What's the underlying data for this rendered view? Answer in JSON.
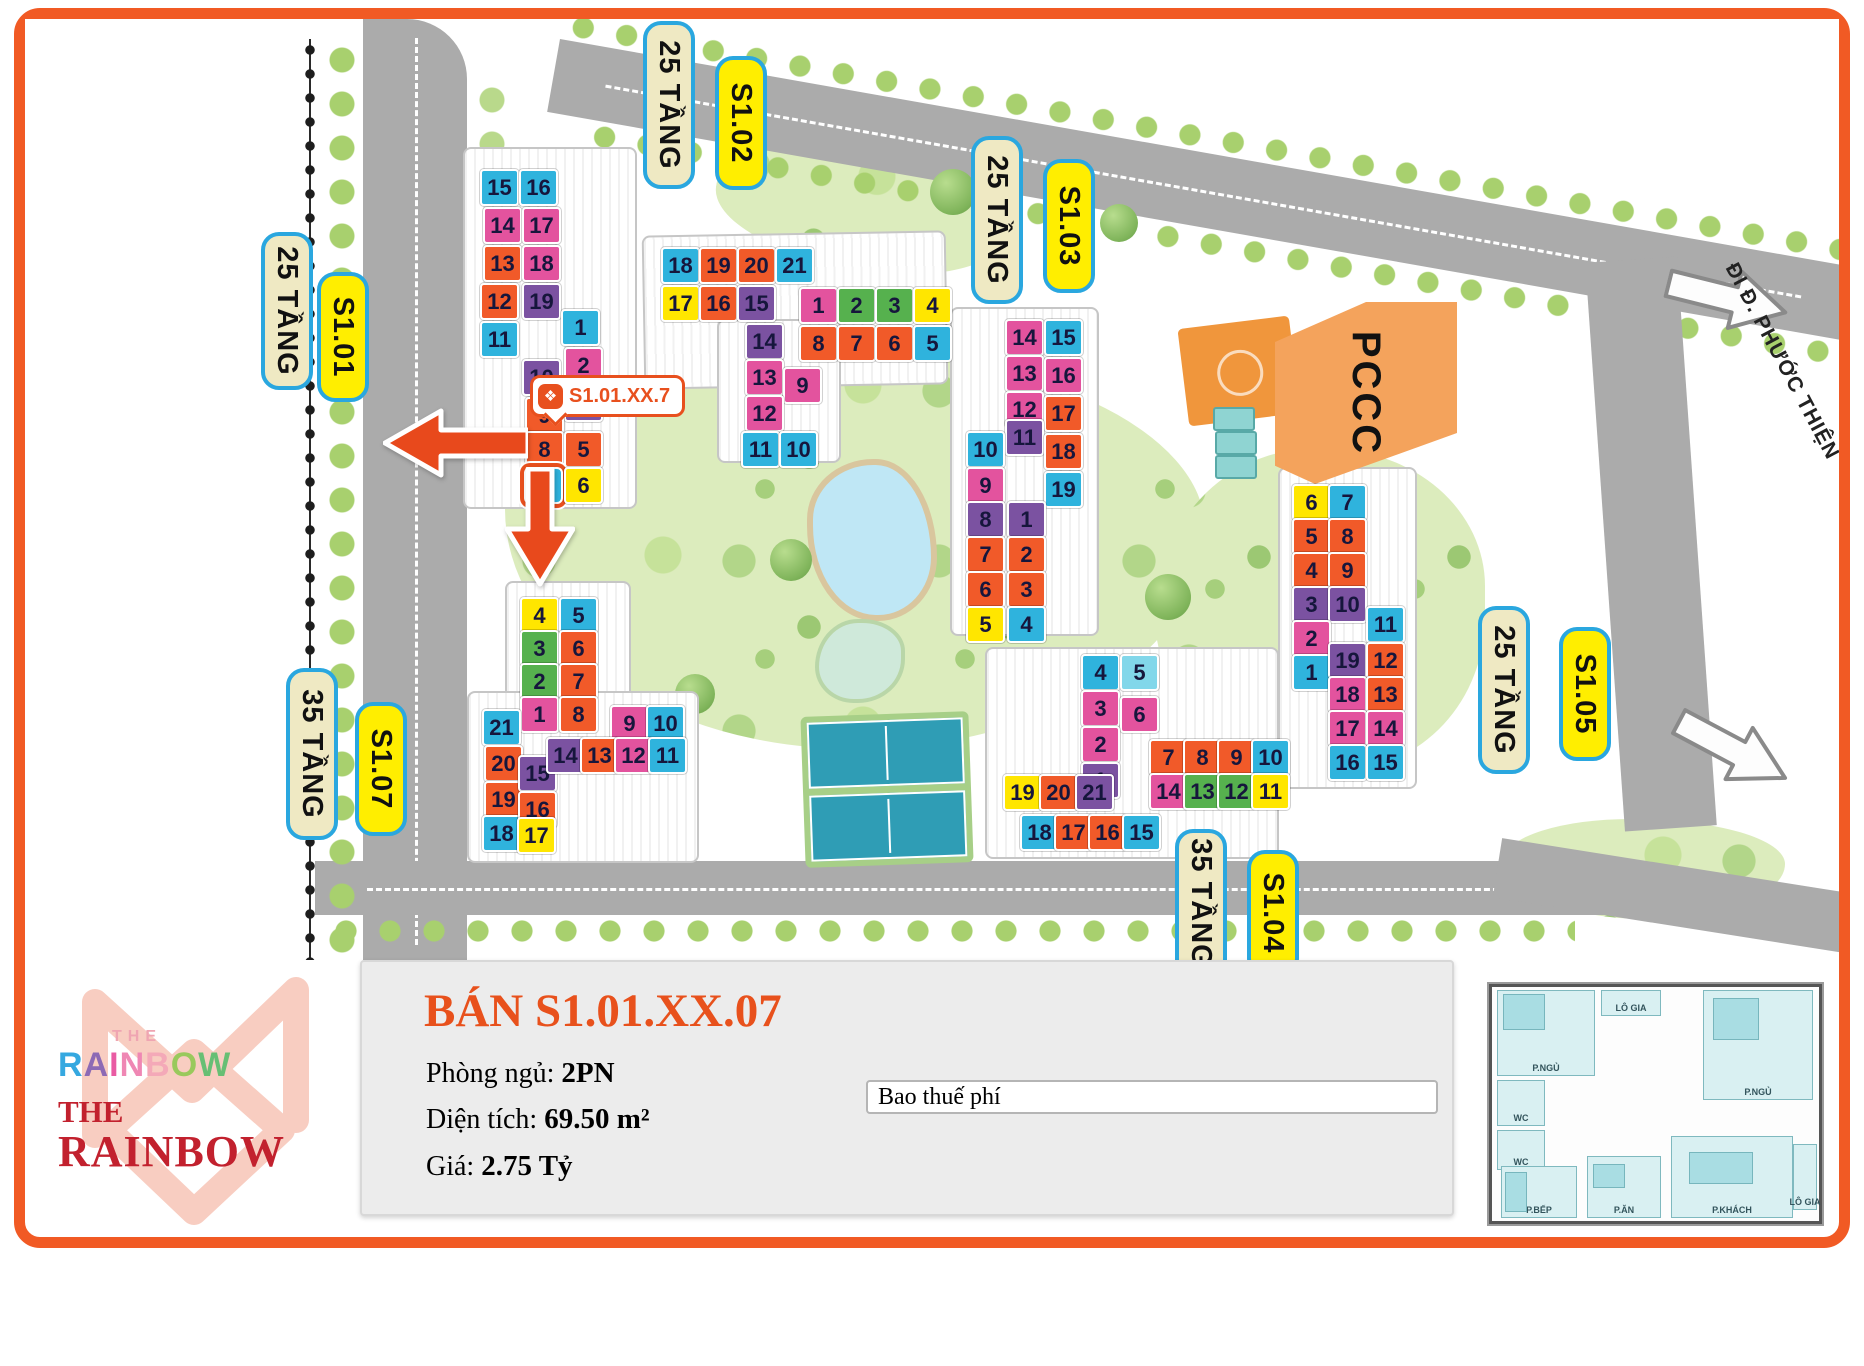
{
  "palette": {
    "cyan": "#2fb3dd",
    "pink": "#e3539e",
    "orange": "#f15a29",
    "purple": "#7b52a1",
    "yellow": "#ffe600",
    "green": "#56b14e",
    "light_cyan": "#82d7ea",
    "highlight": "#e8501e",
    "label_cream": "#efe9c3",
    "label_yellow": "#ffee00",
    "label_border": "#2aa7df",
    "accent": "#e8511c",
    "brand_red": "#c2212e"
  },
  "map": {
    "pccc_label": "PCCC",
    "road_name": "ĐI Đ. PHƯỚC THIỆN",
    "marker": {
      "icon": "rainbow-logo-icon",
      "text": "S1.01.XX.7"
    },
    "labels": [
      {
        "text": "25 TẦNG",
        "style": "cream"
      },
      {
        "text": "S1.01",
        "style": "yellow"
      },
      {
        "text": "25 TẦNG",
        "style": "cream"
      },
      {
        "text": "S1.02",
        "style": "yellow"
      },
      {
        "text": "25 TẦNG",
        "style": "cream"
      },
      {
        "text": "S1.03",
        "style": "yellow"
      },
      {
        "text": "35 TẦNG",
        "style": "cream"
      },
      {
        "text": "S1.07",
        "style": "yellow"
      },
      {
        "text": "25 TẦNG",
        "style": "cream"
      },
      {
        "text": "S1.05",
        "style": "yellow"
      },
      {
        "text": "35 TẦNG",
        "style": "cream"
      },
      {
        "text": "S1.04",
        "style": "yellow"
      }
    ],
    "buildings": [
      {
        "id": "s101",
        "name": "S1.01",
        "tiles": [
          {
            "n": "15",
            "c": "cy",
            "x": 0,
            "y": 0
          },
          {
            "n": "16",
            "c": "cy",
            "x": 39,
            "y": 0
          },
          {
            "n": "14",
            "c": "pk",
            "x": 3,
            "y": 38
          },
          {
            "n": "17",
            "c": "pk",
            "x": 42,
            "y": 38
          },
          {
            "n": "13",
            "c": "or",
            "x": 3,
            "y": 76
          },
          {
            "n": "18",
            "c": "pk",
            "x": 42,
            "y": 76
          },
          {
            "n": "12",
            "c": "or",
            "x": 0,
            "y": 114
          },
          {
            "n": "19",
            "c": "pu",
            "x": 42,
            "y": 114
          },
          {
            "n": "11",
            "c": "cy",
            "x": 0,
            "y": 152
          },
          {
            "n": "1",
            "c": "cy",
            "x": 81,
            "y": 140
          },
          {
            "n": "2",
            "c": "pk",
            "x": 84,
            "y": 178
          },
          {
            "n": "10",
            "c": "pu",
            "x": 42,
            "y": 190
          },
          {
            "n": "3",
            "c": "pu",
            "x": 84,
            "y": 216
          },
          {
            "n": "9",
            "c": "or",
            "x": 45,
            "y": 228
          },
          {
            "n": "8",
            "c": "or",
            "x": 45,
            "y": 262
          },
          {
            "n": "5",
            "c": "or",
            "x": 84,
            "y": 262
          },
          {
            "n": "7",
            "c": "cy",
            "x": 44,
            "y": 298,
            "hl": true
          },
          {
            "n": "6",
            "c": "ye",
            "x": 84,
            "y": 298
          }
        ]
      },
      {
        "id": "s102",
        "name": "S1.02",
        "tiles": [
          {
            "n": "18",
            "c": "cy",
            "x": 0,
            "y": 0
          },
          {
            "n": "19",
            "c": "or",
            "x": 38,
            "y": 0
          },
          {
            "n": "20",
            "c": "or",
            "x": 76,
            "y": 0
          },
          {
            "n": "21",
            "c": "cy",
            "x": 114,
            "y": 0
          },
          {
            "n": "17",
            "c": "ye",
            "x": 0,
            "y": 38
          },
          {
            "n": "16",
            "c": "or",
            "x": 38,
            "y": 38
          },
          {
            "n": "15",
            "c": "pu",
            "x": 76,
            "y": 38
          },
          {
            "n": "14",
            "c": "pu",
            "x": 84,
            "y": 76
          },
          {
            "n": "13",
            "c": "pk",
            "x": 84,
            "y": 112
          },
          {
            "n": "9",
            "c": "pk",
            "x": 122,
            "y": 120
          },
          {
            "n": "12",
            "c": "pk",
            "x": 84,
            "y": 148
          },
          {
            "n": "11",
            "c": "cy",
            "x": 80,
            "y": 184
          },
          {
            "n": "10",
            "c": "cy",
            "x": 118,
            "y": 184
          },
          {
            "n": "1",
            "c": "pk",
            "x": 138,
            "y": 40
          },
          {
            "n": "2",
            "c": "gr",
            "x": 176,
            "y": 40
          },
          {
            "n": "3",
            "c": "gr",
            "x": 214,
            "y": 40
          },
          {
            "n": "4",
            "c": "ye",
            "x": 252,
            "y": 40
          },
          {
            "n": "8",
            "c": "or",
            "x": 138,
            "y": 78
          },
          {
            "n": "7",
            "c": "or",
            "x": 176,
            "y": 78
          },
          {
            "n": "6",
            "c": "or",
            "x": 214,
            "y": 78
          },
          {
            "n": "5",
            "c": "cy",
            "x": 252,
            "y": 78
          }
        ]
      },
      {
        "id": "s103",
        "name": "S1.03",
        "tiles": [
          {
            "n": "14",
            "c": "pk",
            "x": 39,
            "y": 0
          },
          {
            "n": "15",
            "c": "cy",
            "x": 78,
            "y": 0
          },
          {
            "n": "13",
            "c": "pk",
            "x": 39,
            "y": 36
          },
          {
            "n": "16",
            "c": "pk",
            "x": 78,
            "y": 38
          },
          {
            "n": "12",
            "c": "pk",
            "x": 39,
            "y": 72
          },
          {
            "n": "17",
            "c": "or",
            "x": 78,
            "y": 76
          },
          {
            "n": "11",
            "c": "pu",
            "x": 39,
            "y": 100
          },
          {
            "n": "18",
            "c": "or",
            "x": 78,
            "y": 114
          },
          {
            "n": "19",
            "c": "cy",
            "x": 78,
            "y": 152
          },
          {
            "n": "10",
            "c": "cy",
            "x": 0,
            "y": 112
          },
          {
            "n": "9",
            "c": "pk",
            "x": 0,
            "y": 148
          },
          {
            "n": "8",
            "c": "pu",
            "x": 0,
            "y": 182
          },
          {
            "n": "1",
            "c": "pu",
            "x": 41,
            "y": 182
          },
          {
            "n": "7",
            "c": "or",
            "x": 0,
            "y": 217
          },
          {
            "n": "2",
            "c": "or",
            "x": 41,
            "y": 217
          },
          {
            "n": "6",
            "c": "or",
            "x": 0,
            "y": 252
          },
          {
            "n": "3",
            "c": "or",
            "x": 41,
            "y": 252
          },
          {
            "n": "5",
            "c": "ye",
            "x": 0,
            "y": 287
          },
          {
            "n": "4",
            "c": "cy",
            "x": 41,
            "y": 287
          }
        ]
      },
      {
        "id": "s104",
        "name": "S1.04",
        "tiles": [
          {
            "n": "4",
            "c": "cy",
            "x": 8,
            "y": 0
          },
          {
            "n": "5",
            "c": "lc",
            "x": 47,
            "y": 0
          },
          {
            "n": "3",
            "c": "pk",
            "x": 8,
            "y": 36
          },
          {
            "n": "6",
            "c": "pk",
            "x": 47,
            "y": 42
          },
          {
            "n": "2",
            "c": "pk",
            "x": 8,
            "y": 72
          },
          {
            "n": "1",
            "c": "pu",
            "x": 8,
            "y": 108
          },
          {
            "n": "19",
            "c": "ye",
            "x": -70,
            "y": 120
          },
          {
            "n": "20",
            "c": "or",
            "x": -34,
            "y": 120
          },
          {
            "n": "21",
            "c": "pu",
            "x": 2,
            "y": 120
          },
          {
            "n": "7",
            "c": "or",
            "x": 76,
            "y": 85
          },
          {
            "n": "8",
            "c": "or",
            "x": 110,
            "y": 85
          },
          {
            "n": "9",
            "c": "or",
            "x": 144,
            "y": 85
          },
          {
            "n": "10",
            "c": "cy",
            "x": 178,
            "y": 85
          },
          {
            "n": "14",
            "c": "pk",
            "x": 76,
            "y": 119
          },
          {
            "n": "13",
            "c": "gr",
            "x": 110,
            "y": 119
          },
          {
            "n": "12",
            "c": "gr",
            "x": 144,
            "y": 119
          },
          {
            "n": "11",
            "c": "ye",
            "x": 178,
            "y": 119
          },
          {
            "n": "18",
            "c": "cy",
            "x": -53,
            "y": 160
          },
          {
            "n": "17",
            "c": "or",
            "x": -19,
            "y": 160
          },
          {
            "n": "16",
            "c": "or",
            "x": 15,
            "y": 160
          },
          {
            "n": "15",
            "c": "cy",
            "x": 49,
            "y": 160
          }
        ]
      },
      {
        "id": "s105",
        "name": "S1.05",
        "tiles": [
          {
            "n": "6",
            "c": "ye",
            "x": 0,
            "y": 0
          },
          {
            "n": "7",
            "c": "cy",
            "x": 36,
            "y": 0
          },
          {
            "n": "5",
            "c": "or",
            "x": 0,
            "y": 34
          },
          {
            "n": "8",
            "c": "or",
            "x": 36,
            "y": 34
          },
          {
            "n": "4",
            "c": "or",
            "x": 0,
            "y": 68
          },
          {
            "n": "9",
            "c": "or",
            "x": 36,
            "y": 68
          },
          {
            "n": "3",
            "c": "pu",
            "x": 0,
            "y": 102
          },
          {
            "n": "10",
            "c": "pu",
            "x": 36,
            "y": 102
          },
          {
            "n": "2",
            "c": "pk",
            "x": 0,
            "y": 136
          },
          {
            "n": "1",
            "c": "cy",
            "x": 0,
            "y": 170
          },
          {
            "n": "11",
            "c": "cy",
            "x": 74,
            "y": 122
          },
          {
            "n": "19",
            "c": "pu",
            "x": 36,
            "y": 158
          },
          {
            "n": "12",
            "c": "or",
            "x": 74,
            "y": 158
          },
          {
            "n": "18",
            "c": "pk",
            "x": 36,
            "y": 192
          },
          {
            "n": "13",
            "c": "or",
            "x": 74,
            "y": 192
          },
          {
            "n": "17",
            "c": "pk",
            "x": 36,
            "y": 226
          },
          {
            "n": "14",
            "c": "pk",
            "x": 74,
            "y": 226
          },
          {
            "n": "16",
            "c": "cy",
            "x": 36,
            "y": 260
          },
          {
            "n": "15",
            "c": "cy",
            "x": 74,
            "y": 260
          }
        ]
      },
      {
        "id": "s107",
        "name": "S1.07",
        "tiles": [
          {
            "n": "4",
            "c": "ye",
            "x": 40,
            "y": 0
          },
          {
            "n": "5",
            "c": "cy",
            "x": 79,
            "y": 0
          },
          {
            "n": "3",
            "c": "gr",
            "x": 40,
            "y": 33
          },
          {
            "n": "6",
            "c": "or",
            "x": 79,
            "y": 33
          },
          {
            "n": "2",
            "c": "gr",
            "x": 40,
            "y": 66
          },
          {
            "n": "7",
            "c": "or",
            "x": 79,
            "y": 66
          },
          {
            "n": "1",
            "c": "pk",
            "x": 40,
            "y": 99
          },
          {
            "n": "8",
            "c": "or",
            "x": 79,
            "y": 99
          },
          {
            "n": "21",
            "c": "cy",
            "x": 2,
            "y": 112
          },
          {
            "n": "20",
            "c": "or",
            "x": 4,
            "y": 148
          },
          {
            "n": "19",
            "c": "or",
            "x": 4,
            "y": 184
          },
          {
            "n": "18",
            "c": "cy",
            "x": 2,
            "y": 218
          },
          {
            "n": "15",
            "c": "pu",
            "x": 38,
            "y": 158
          },
          {
            "n": "16",
            "c": "or",
            "x": 38,
            "y": 194
          },
          {
            "n": "17",
            "c": "ye",
            "x": 37,
            "y": 220
          },
          {
            "n": "9",
            "c": "pk",
            "x": 130,
            "y": 108
          },
          {
            "n": "10",
            "c": "cy",
            "x": 166,
            "y": 108
          },
          {
            "n": "14",
            "c": "pu",
            "x": 66,
            "y": 140
          },
          {
            "n": "13",
            "c": "or",
            "x": 100,
            "y": 140
          },
          {
            "n": "12",
            "c": "pk",
            "x": 134,
            "y": 140
          },
          {
            "n": "11",
            "c": "cy",
            "x": 168,
            "y": 140
          }
        ]
      }
    ]
  },
  "panel": {
    "title": "BÁN S1.01.XX.07",
    "rows": [
      {
        "label": "Phòng ngủ: ",
        "value": "2PN"
      },
      {
        "label": "Diện tích: ",
        "value": "69.50 m²"
      },
      {
        "label": "Giá: ",
        "value": "2.75 Tỷ"
      }
    ],
    "input_value": "Bao thuế phí"
  },
  "logo": {
    "the_small": "THE",
    "rainbow_letters": [
      {
        "ch": "R",
        "color": "#35a8e0"
      },
      {
        "ch": "A",
        "color": "#8d6ab5"
      },
      {
        "ch": "I",
        "color": "#e95ba3"
      },
      {
        "ch": "N",
        "color": "#ef87b4"
      },
      {
        "ch": "B",
        "color": "#f4a9b8"
      },
      {
        "ch": "O",
        "color": "#99c95c"
      },
      {
        "ch": "W",
        "color": "#67bf74"
      }
    ],
    "the_serif": "THE",
    "rainbow_serif": "RAINBOW"
  },
  "floorplan": {
    "rooms": [
      "P.NGỦ",
      "LÔ GIA",
      "P.NGỦ",
      "WC",
      "WC",
      "P.BẾP",
      "P.ĂN",
      "P.KHÁCH",
      "LÔ GIA"
    ]
  }
}
